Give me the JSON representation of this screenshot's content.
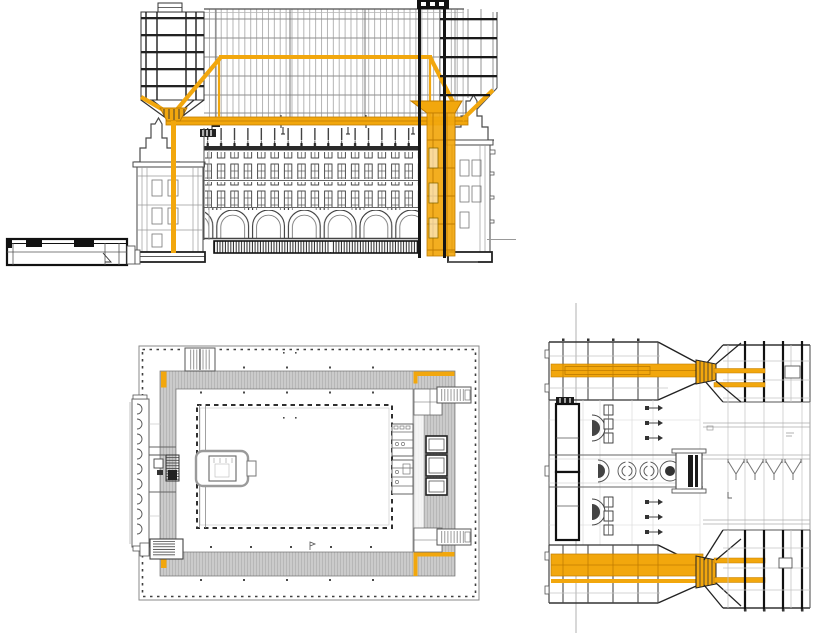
{
  "page": {
    "background": "#ffffff",
    "kind": "architectural-drawing-set",
    "figure_count": 3
  },
  "colors": {
    "highlight": "#F2A70D",
    "highlight-dark": "#C07C00",
    "ink": "#1a1a1a",
    "line-mid": "#4d4d4d",
    "line-light": "#9a9a9a",
    "line-faint": "#c9c9c9",
    "plan-gray": "#cbcbcb",
    "plan-hatch": "#b7b7b7",
    "white": "#ffffff"
  },
  "figures": [
    {
      "id": "section",
      "name": "cross-section-elevation",
      "position": "top",
      "highlighted": "truss, leg and vertical core in orange"
    },
    {
      "id": "floor-plan",
      "name": "floor-plan",
      "position": "bottom-left",
      "highlighted": "four leg footprints in orange"
    },
    {
      "id": "roof-plan",
      "name": "roof-structure-plan",
      "position": "bottom-right",
      "highlighted": "twin transfer beams in orange"
    }
  ]
}
